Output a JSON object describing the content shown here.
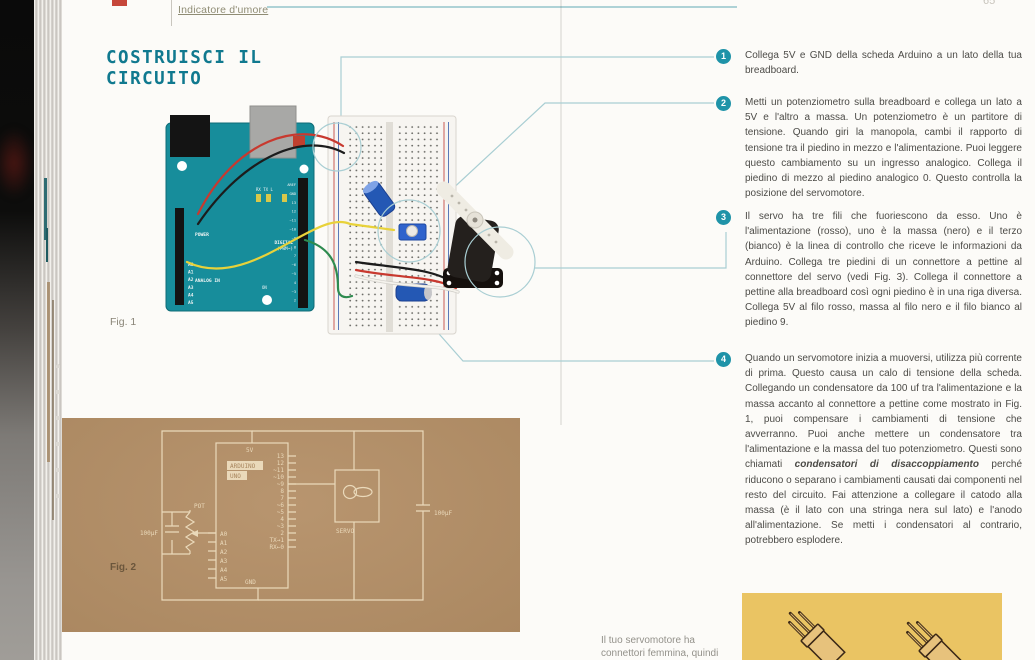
{
  "header": {
    "section_link": "Indicatore d'umore",
    "page_number": "65"
  },
  "title": {
    "line1": "COSTRUISCI IL",
    "line2": "CIRCUITO"
  },
  "figures": {
    "fig1_label": "Fig. 1",
    "fig2_label": "Fig. 2"
  },
  "steps": [
    {
      "number": "1",
      "text": "Collega 5V e GND della scheda Arduino a un lato della tua breadboard."
    },
    {
      "number": "2",
      "text": "Metti un potenziometro sulla breadboard e collega un lato a 5V e l'altro a massa. Un potenziometro è un partitore di tensione. Quando giri la manopola, cambi il rapporto di tensione tra il piedino in mezzo e l'alimentazione. Puoi leggere questo cambiamento su un ingresso analogico. Collega il piedino di mezzo al piedino analogico 0. Questo controlla la posizione del servomotore."
    },
    {
      "number": "3",
      "text": "Il servo ha tre fili che fuoriescono da esso. Uno è l'alimentazione (rosso), uno è la massa (nero) e il terzo (bianco) è la linea di controllo che riceve le informazioni da Arduino. Collega tre piedini di un connettore a pettine al connettore del servo (vedi Fig. 3). Collega il connettore a pettine alla breadboard così ogni piedino è in una riga diversa. Collega 5V al filo rosso, massa al filo nero e il filo bianco al piedino 9."
    },
    {
      "number": "4",
      "before": "Quando un servomotore inizia a muoversi, utilizza più corrente di prima. Questo causa un calo di tensione della scheda. Collegando un condensatore da 100 uf tra l'alimentazione e la massa accanto al connettore a pettine come mostrato in Fig. 1, puoi compensare i cambiamenti di tensione che avverranno. Puoi anche mettere un condensatore tra l'alimentazione e la massa del tuo potenziometro. Questi sono chiamati ",
      "bold": "condensatori di disaccoppiamento",
      "after": " perché riducono o separano i cambiamenti causati dai componenti nel resto del circuito. Fai attenzione a collegare il catodo alla massa (è il lato con una stringa nera sul lato) e l'anodo all'alimentazione. Se metti i condensatori al contrario, potrebbero esplodere."
    }
  ],
  "caption": {
    "line1": "Il tuo servomotore ha",
    "line2": "connettori femmina, quindi"
  },
  "fig1": {
    "arduino": {
      "power_label": "POWER",
      "analog_label": "ANALOG IN",
      "digital_label": "DIGITAL",
      "pwm_label": "(PWM~)",
      "on_label": "ON",
      "led_labels": "RX TX  L",
      "analog_pins": [
        "A0",
        "A1",
        "A2",
        "A3",
        "A4",
        "A5"
      ],
      "digital_pins": [
        "AREF",
        "GND",
        "13",
        "12",
        "~11",
        "~10",
        "~9",
        "8",
        "7",
        "~6",
        "~5",
        "4",
        "~3",
        "2"
      ]
    }
  },
  "fig2": {
    "top_pin": "5V",
    "bottom_pin": "GND",
    "name1": "ARDUINO",
    "name2": "UNO",
    "pot_label": "POT",
    "cap_left_label": "100μF",
    "cap_right_label": "100μF",
    "servo_label": "SERVO",
    "left_pins": [
      "A0",
      "A1",
      "A2",
      "A3",
      "A4",
      "A5"
    ],
    "right_pins": [
      "13",
      "12",
      "~11",
      "~10",
      "~9",
      "8",
      "7",
      "~6",
      "~5",
      "4",
      "~3",
      "2",
      "TX→1",
      "RX←0"
    ]
  },
  "colors": {
    "accent_teal": "#10798f",
    "bullet_teal": "#1f93a8",
    "callout_teal": "#a9ced3",
    "kraft": "#b3906a",
    "panel_yellow": "#eac463",
    "arduino_board": "#178d9b"
  }
}
